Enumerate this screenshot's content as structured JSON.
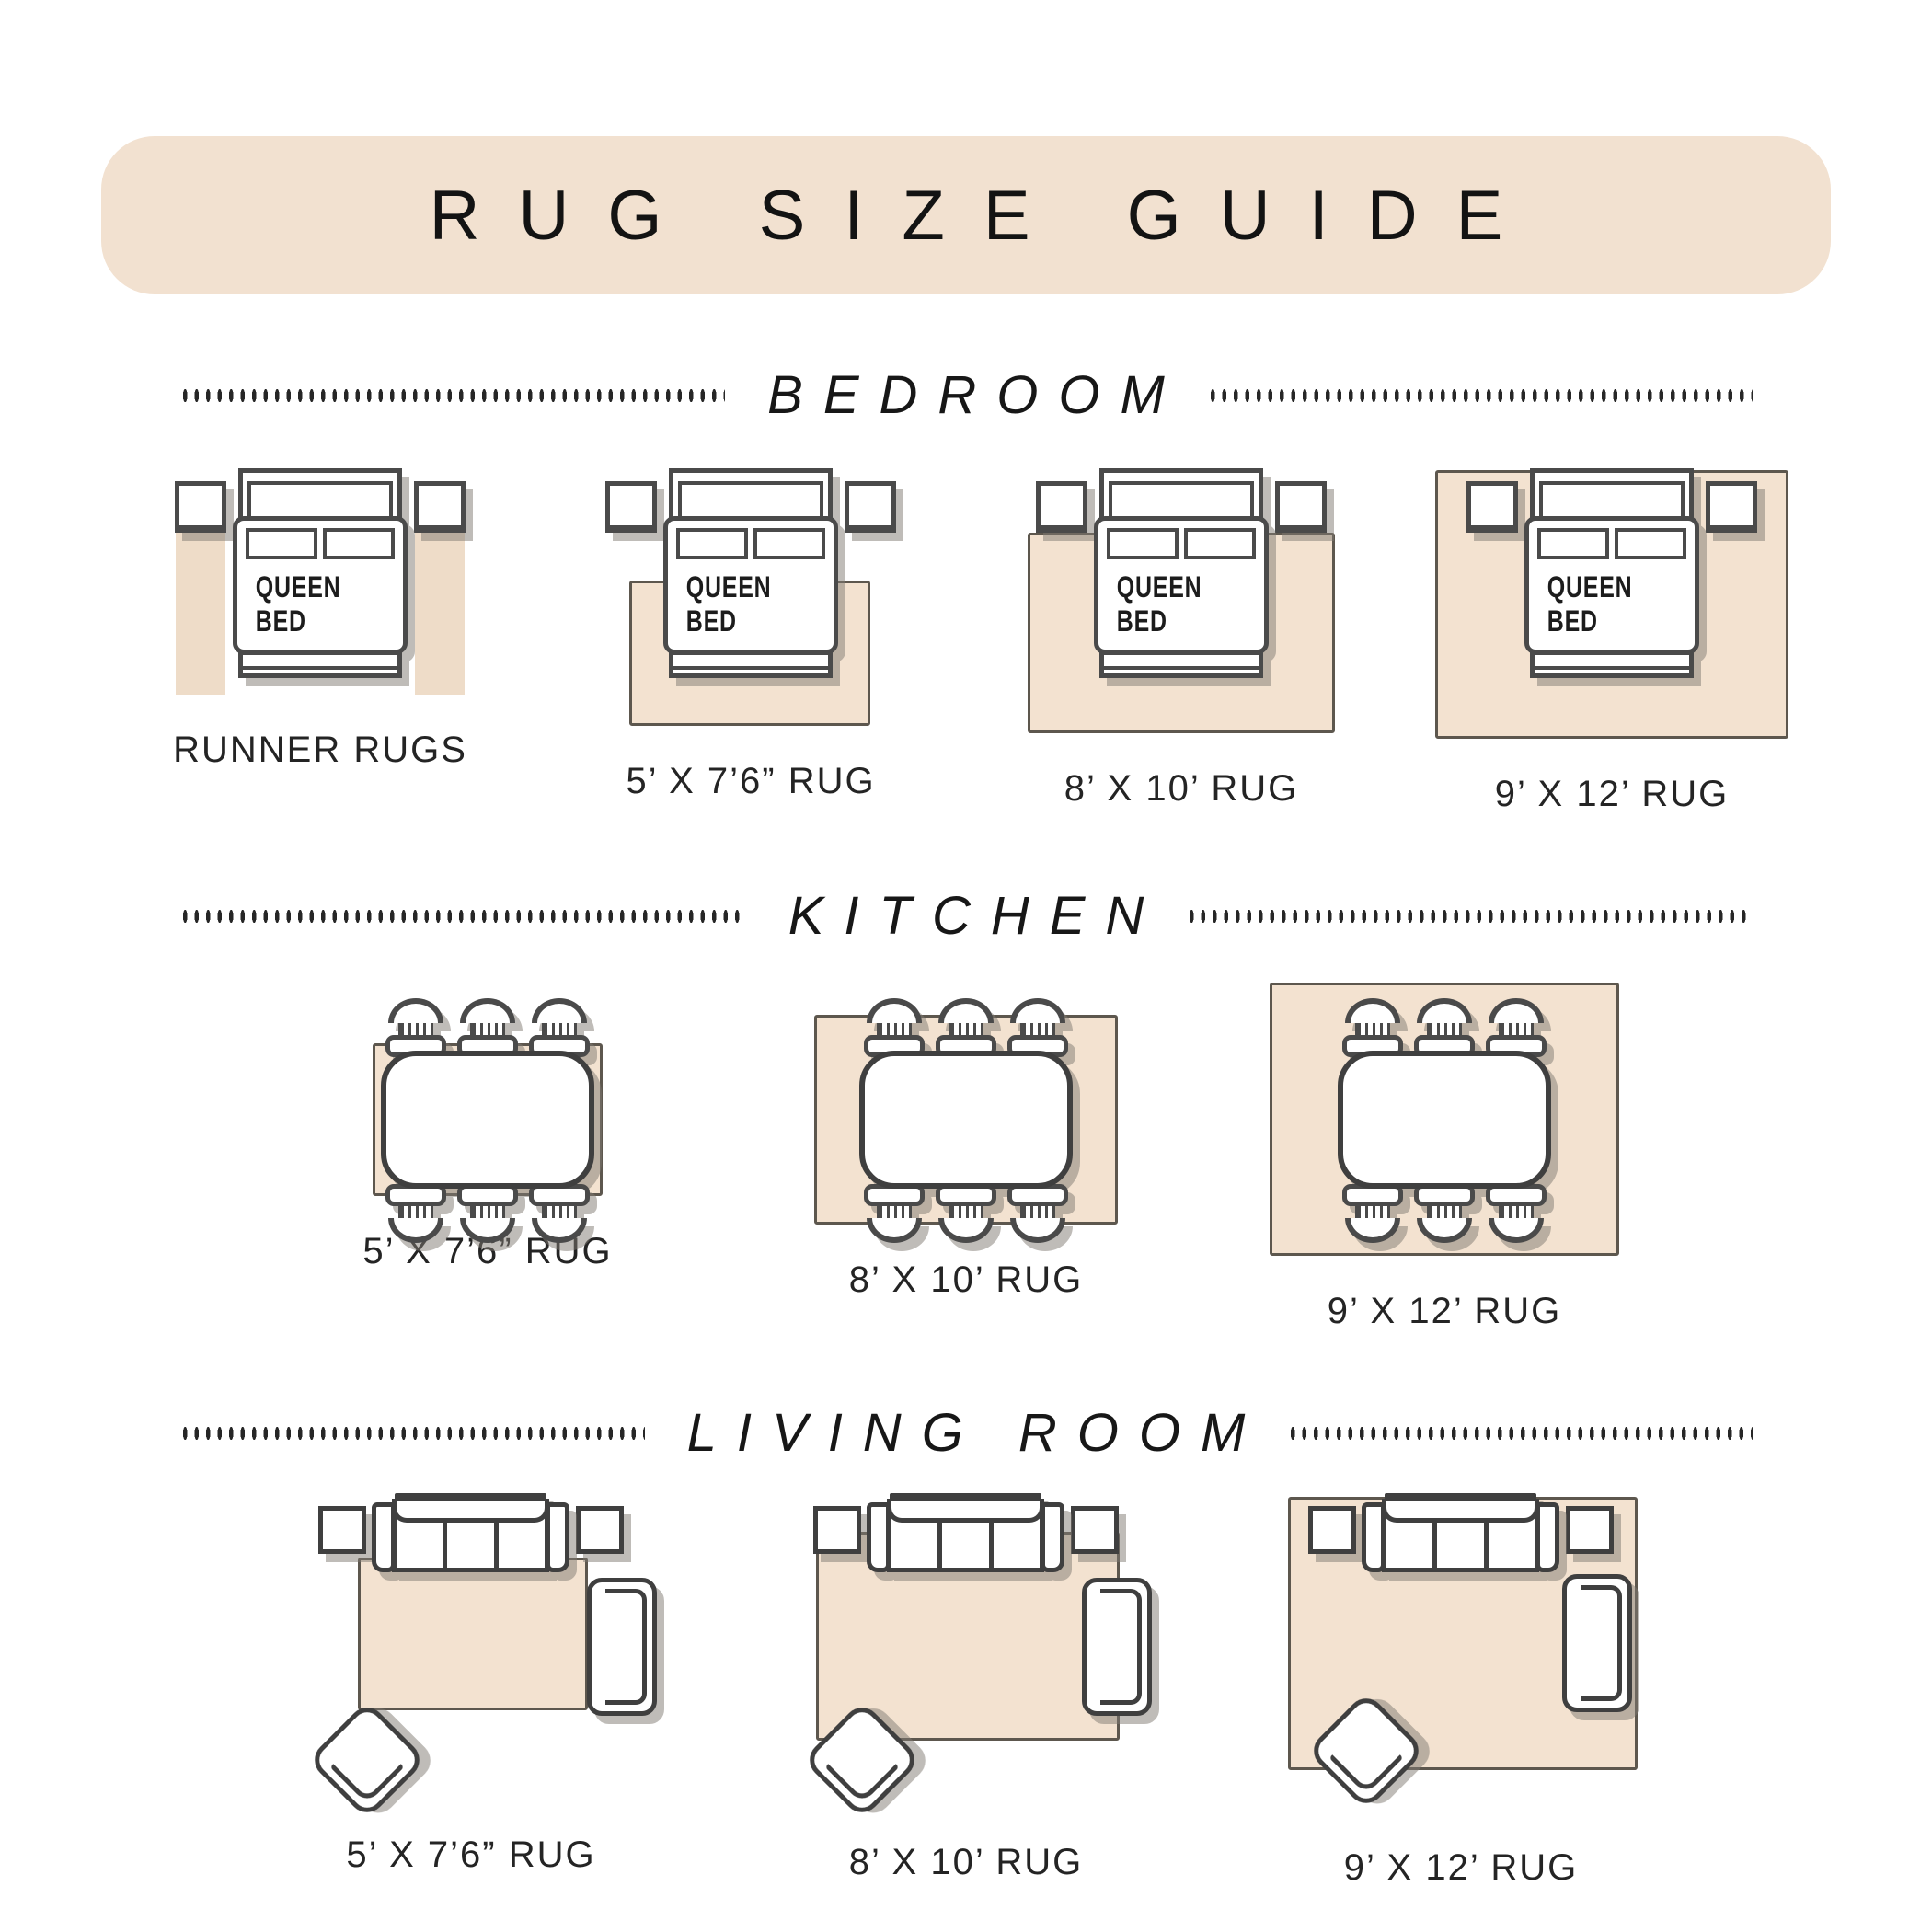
{
  "title": "RUG SIZE GUIDE",
  "colors": {
    "banner": "#f2e1d0",
    "rug": "#f3e2d0",
    "runner": "#eedcc8",
    "outline": "#3f3f3f",
    "ink": "#1c1c1c"
  },
  "sections": {
    "bedroom": {
      "label": "BEDROOM",
      "bed_label": "QUEEN BED",
      "items": [
        {
          "caption": "RUNNER RUGS"
        },
        {
          "caption": "5’ X 7’6” RUG"
        },
        {
          "caption": "8’ X 10’ RUG"
        },
        {
          "caption": "9’ X 12’ RUG"
        }
      ]
    },
    "kitchen": {
      "label": "KITCHEN",
      "items": [
        {
          "caption": "5’ X 7’6” RUG"
        },
        {
          "caption": "8’ X 10’ RUG"
        },
        {
          "caption": "9’ X 12’ RUG"
        }
      ]
    },
    "living_room": {
      "label": "LIVING ROOM",
      "items": [
        {
          "caption": "5’ X 7’6” RUG"
        },
        {
          "caption": "8’ X 10’ RUG"
        },
        {
          "caption": "9’ X 12’ RUG"
        }
      ]
    }
  }
}
